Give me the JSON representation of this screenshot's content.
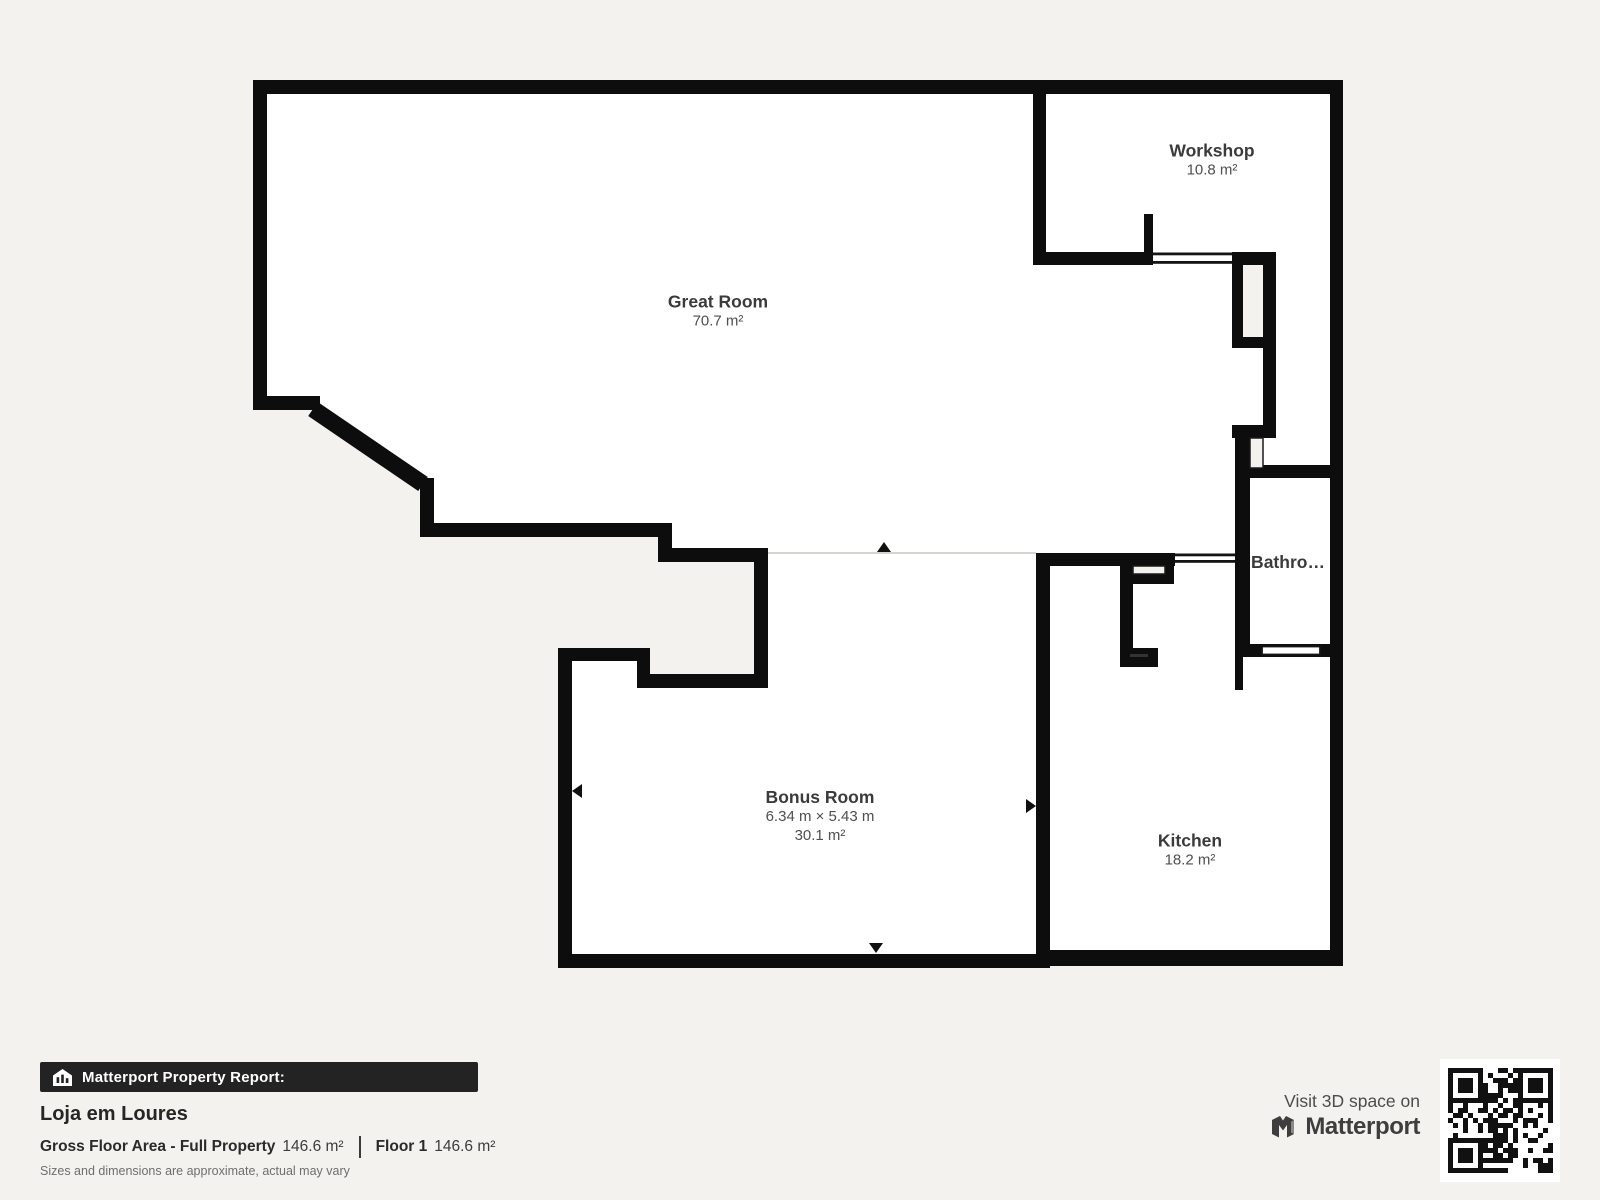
{
  "colors": {
    "wall": "#0d0d0d",
    "background": "#f4f2ef",
    "room-fill": "#ffffff",
    "divider-line": "#d8d5d1",
    "banner-bg": "#232323"
  },
  "floorplan": {
    "rooms": [
      {
        "id": "great-room",
        "name": "Great Room",
        "area": "70.7 m²"
      },
      {
        "id": "workshop",
        "name": "Workshop",
        "area": "10.8 m²"
      },
      {
        "id": "bathroom",
        "name": "Bathro…"
      },
      {
        "id": "bonus-room",
        "name": "Bonus Room",
        "dimensions": "6.34 m × 5.43 m",
        "area": "30.1 m²"
      },
      {
        "id": "kitchen",
        "name": "Kitchen",
        "area": "18.2 m²"
      }
    ]
  },
  "report": {
    "banner_label": "Matterport Property Report:",
    "property_name": "Loja em Loures",
    "gross_floor_area_label": "Gross Floor Area - Full Property",
    "gross_floor_area_value": "146.6 m²",
    "floor_label": "Floor 1",
    "floor_value": "146.6 m²",
    "disclaimer": "Sizes and dimensions are approximate, actual may vary"
  },
  "promo": {
    "visit_text": "Visit 3D space on",
    "brand": "Matterport"
  }
}
